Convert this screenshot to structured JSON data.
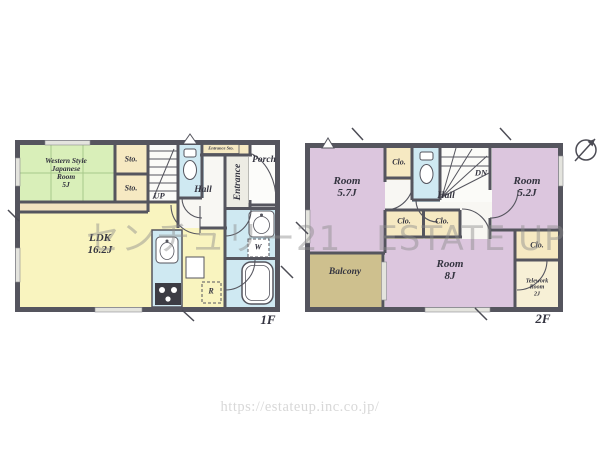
{
  "watermark": "センチュリー21　ESTATE UP",
  "url": "https://estateup.inc.co.jp/",
  "colors": {
    "wall": "#55555e",
    "ldk_yellow": "#f9f4bf",
    "bedroom_purple": "#dcc6de",
    "tatami_green": "#d9efb9",
    "wet_blue": "#cfe9f2",
    "closet_cream": "#f6e9c2",
    "balcony_olive": "#cec08e",
    "watermark_gray": "#8c8c8c"
  },
  "floor1": {
    "floor_label": "1F",
    "western_room": {
      "l1": "Western Style",
      "l2": "Japanese",
      "l3": "Room",
      "l4": "5J"
    },
    "sto_top": "Sto.",
    "sto_bottom": "Sto.",
    "up": "UP",
    "hall": "Hall",
    "entrance": "Entrance",
    "entrance_sto": "Entrance Sto.",
    "porch": "Porch",
    "ldk": {
      "name": "LDK",
      "size": "16.2J"
    },
    "washer": "W",
    "fridge": "R"
  },
  "floor2": {
    "floor_label": "2F",
    "room_57": {
      "name": "Room",
      "size": "5.7J"
    },
    "room_52": {
      "name": "Room",
      "size": "5.2J"
    },
    "room_8": {
      "name": "Room",
      "size": "8J"
    },
    "closet_top": "Clo.",
    "closet_a": "Clo.",
    "closet_b": "Clo.",
    "closet_right": "Clo.",
    "hall": "Hall",
    "dn": "DN",
    "balcony": "Balcony",
    "telework": {
      "l1": "Telework",
      "l2": "Room",
      "l3": "2J"
    }
  }
}
